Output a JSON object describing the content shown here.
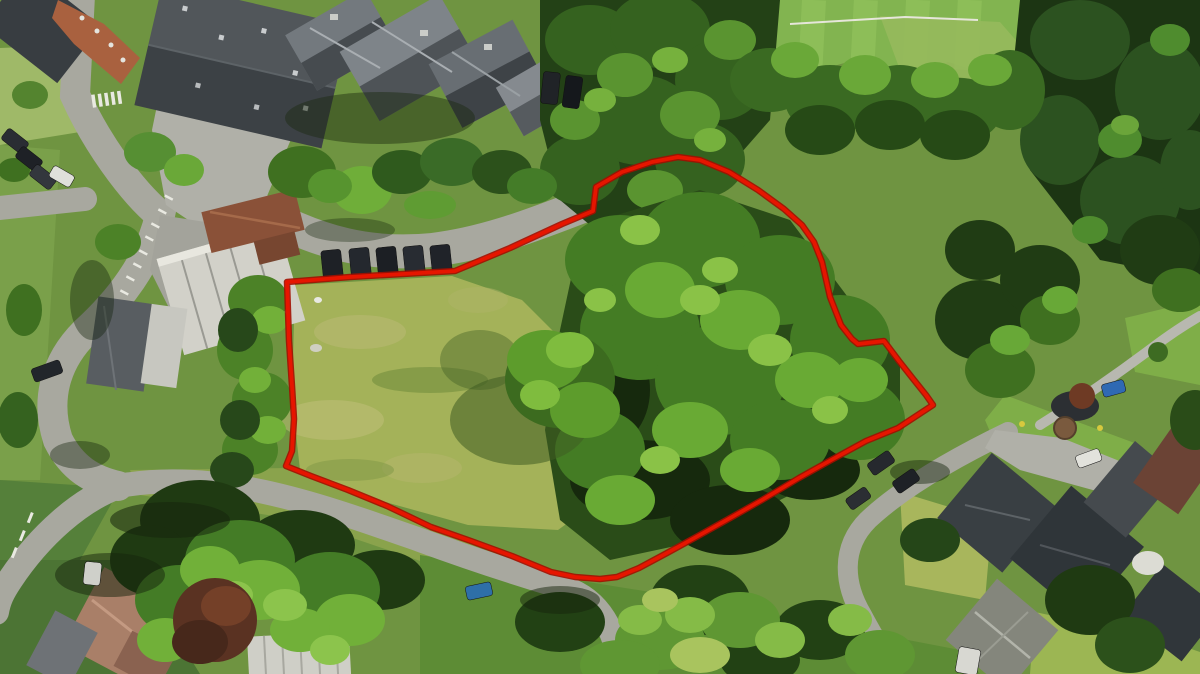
{
  "scene": {
    "kind": "aerial-drone-photograph",
    "overlay": "red-site-boundary-outline"
  },
  "boundary": {
    "points": "287,282 350,277 455,271 510,248 562,224 593,211 596,187 622,172 652,162 678,157 700,160 729,172 758,190 784,209 802,225 814,242 822,262 830,297 841,325 852,339 858,344 884,341 899,361 914,380 926,395 933,405 898,428 866,441 833,459 799,478 762,500 732,517 698,536 667,553 639,568 617,577 600,579 575,577 551,572 529,563 512,556 471,541 431,527 387,506 348,490 311,476 286,466 292,451 294,419 292,386 289,341 287,282",
    "stroke_color": "#e61500",
    "casing_color": "#a30e00"
  },
  "palette": {
    "boundary_red": "#e61500",
    "canopy_dark": "#1f3a12",
    "canopy_mid": "#447c26",
    "canopy_bright": "#7cb83e",
    "site_lawn": "#a4b259",
    "playing_field": "#82b450",
    "road_gray": "#a8a89f",
    "slate_roof_dark": "#474c50",
    "victorian_slate": "#7b8185",
    "marquee_white": "#d2d1c9",
    "brown_roof": "#8a5138",
    "salmon_roof": "#a97f68",
    "copper_beech": "#5a3222",
    "car_blue": "#2e6fa8"
  }
}
